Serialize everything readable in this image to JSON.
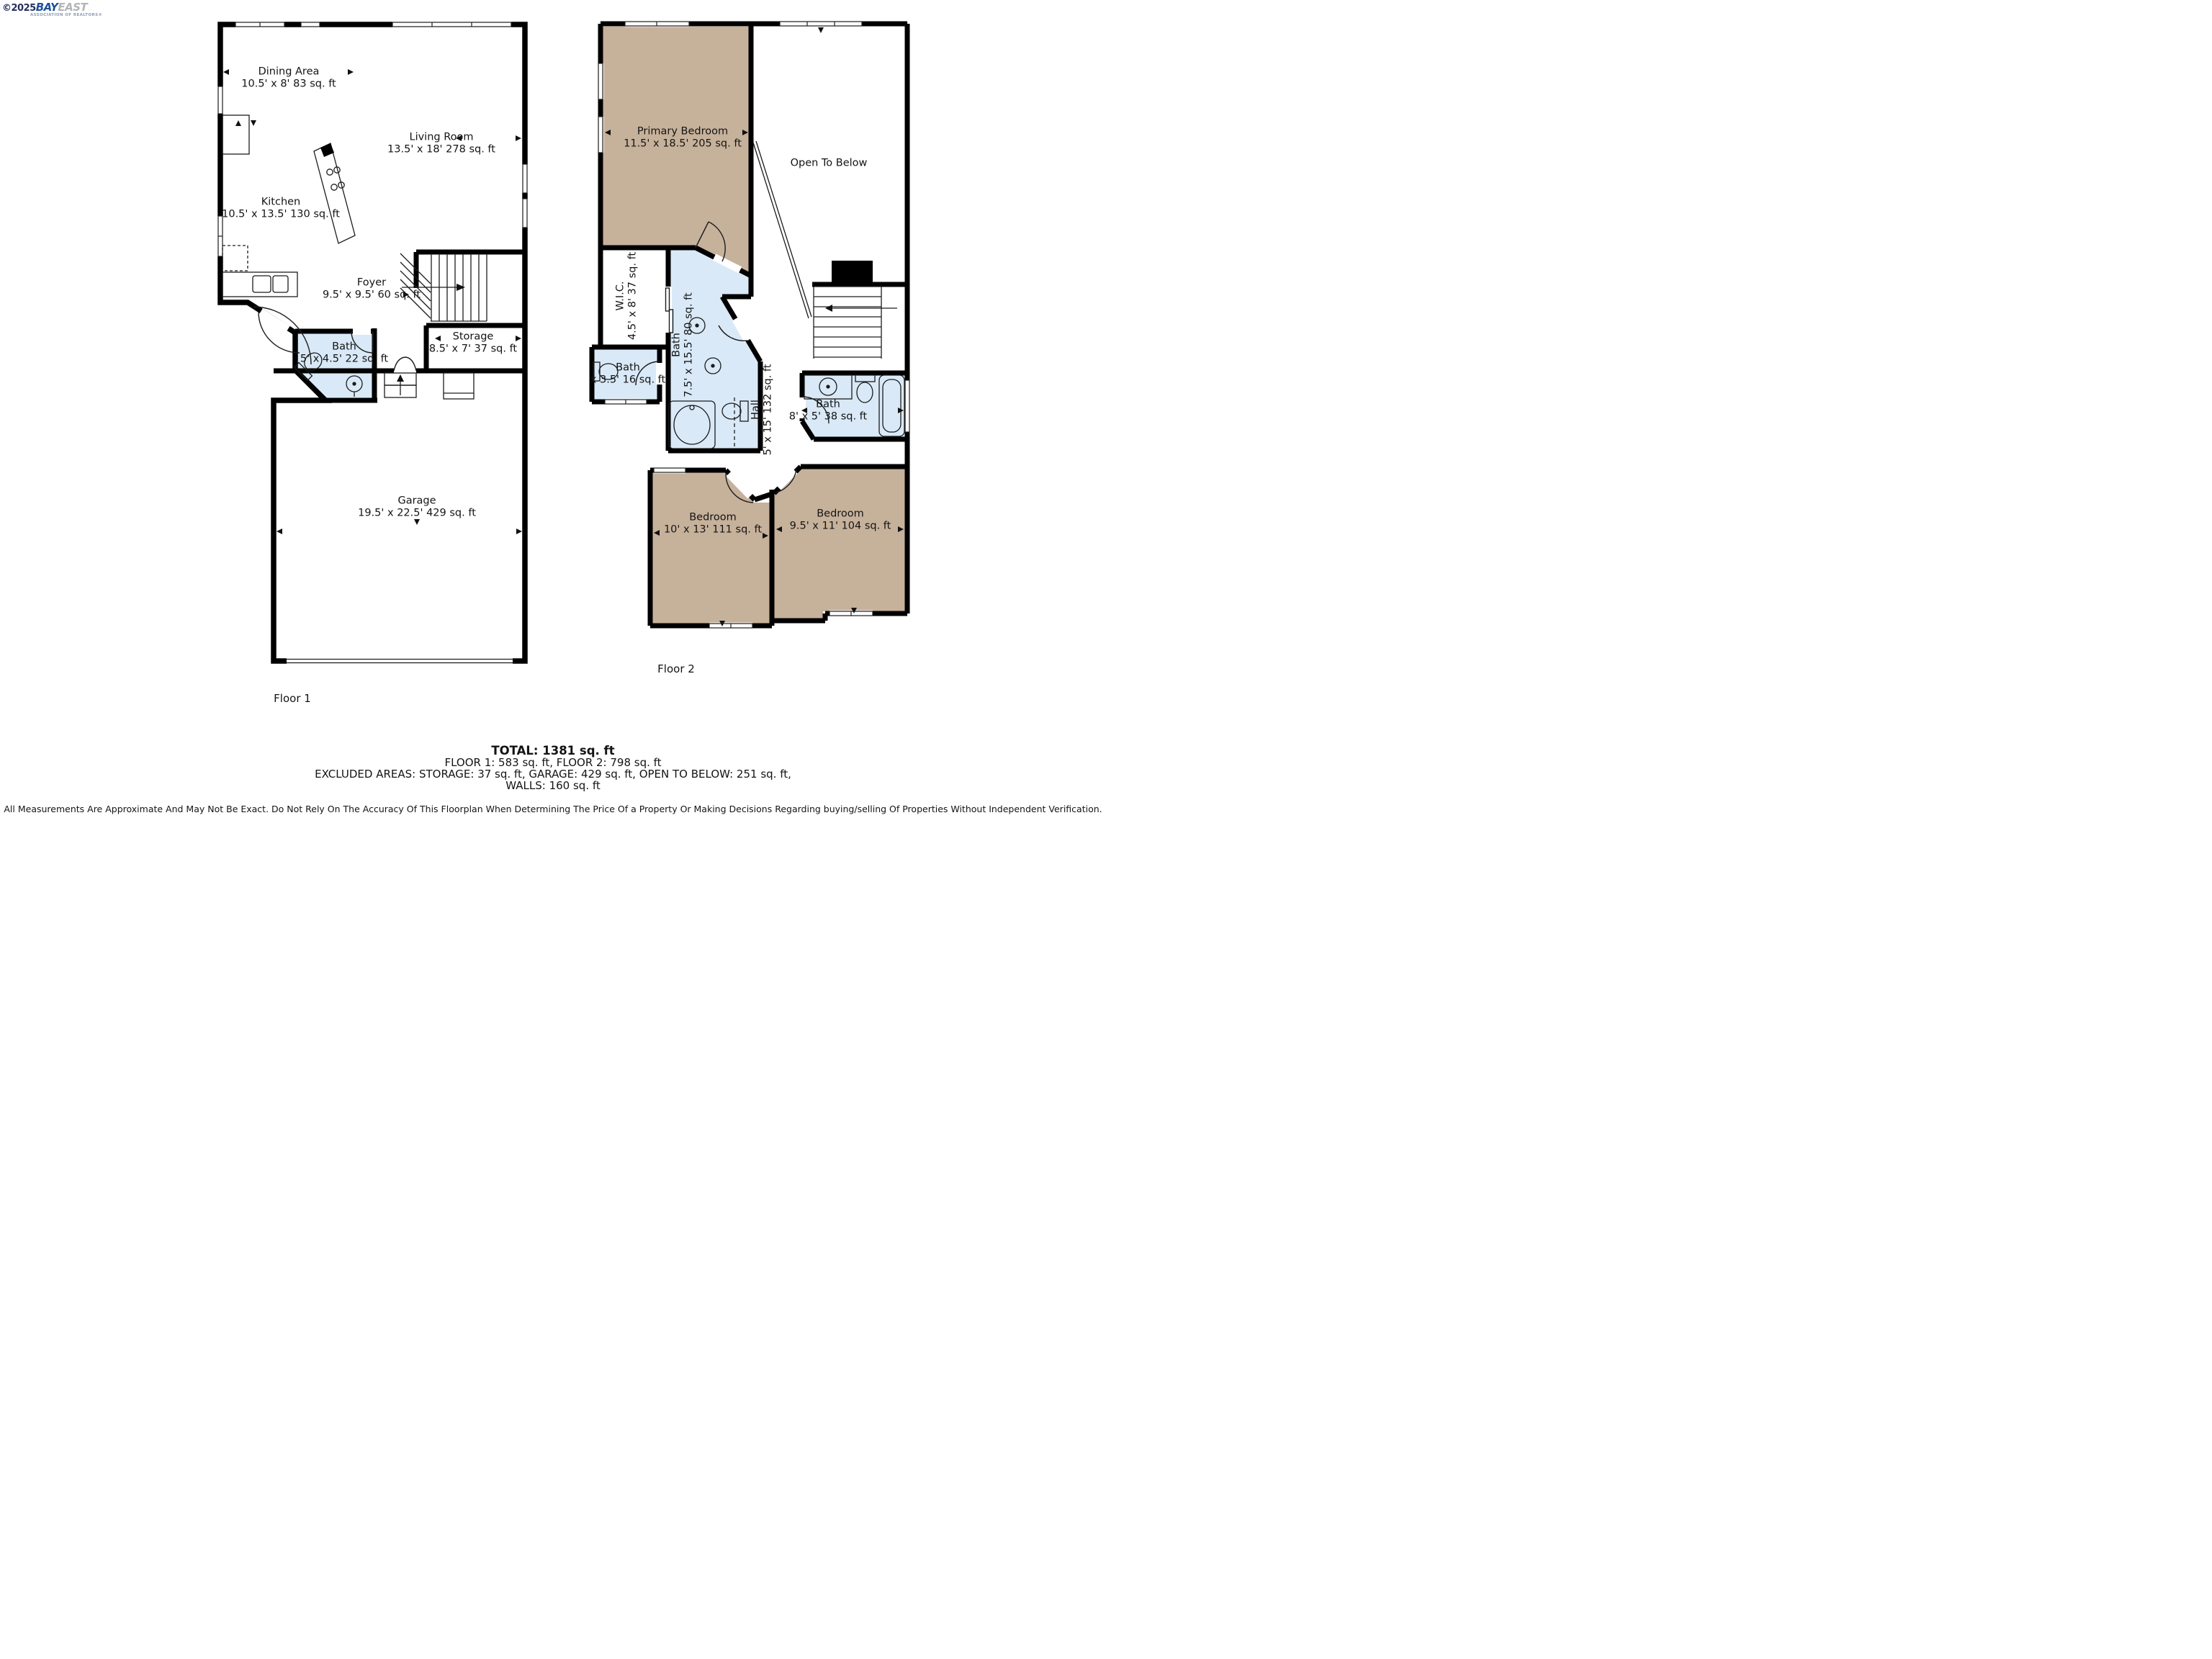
{
  "logo": {
    "copyright": "©2025",
    "brand_primary": "BAY",
    "brand_secondary": "EAST",
    "tagline": "ASSOCIATION OF REALTORS®"
  },
  "floor1": {
    "caption": "Floor 1",
    "rooms": {
      "dining": {
        "name": "Dining Area",
        "dims": "10.5' x 8' 83 sq. ft"
      },
      "living": {
        "name": "Living Room",
        "dims": "13.5' x 18' 278 sq. ft"
      },
      "kitchen": {
        "name": "Kitchen",
        "dims": "10.5' x 13.5' 130 sq. ft"
      },
      "foyer": {
        "name": "Foyer",
        "dims": "9.5' x 9.5' 60 sq. ft"
      },
      "bath": {
        "name": "Bath",
        "dims": "5' x 4.5' 22 sq. ft"
      },
      "storage": {
        "name": "Storage",
        "dims": "8.5' x 7' 37 sq. ft"
      },
      "garage": {
        "name": "Garage",
        "dims": "19.5' x 22.5' 429 sq. ft"
      }
    }
  },
  "floor2": {
    "caption": "Floor 2",
    "rooms": {
      "primary_bedroom": {
        "name": "Primary Bedroom",
        "dims": "11.5' x 18.5' 205 sq. ft"
      },
      "open_to_below": {
        "name": "Open To Below"
      },
      "wic": {
        "name": "W.I.C.",
        "dims": "4.5' x 8' 37 sq. ft"
      },
      "bath_main": {
        "name": "Bath",
        "dims": "7.5' x 15.5' 80 sq. ft"
      },
      "bath_small": {
        "name": "Bath",
        "dims": "x 3.5' 16 sq. ft"
      },
      "hall": {
        "name": "Hall",
        "dims": "5' x 15' 132 sq. ft"
      },
      "bath_right": {
        "name": "Bath",
        "dims": "8' x 5' 38 sq. ft"
      },
      "bedroom_left": {
        "name": "Bedroom",
        "dims": "10' x 13' 111 sq. ft"
      },
      "bedroom_right": {
        "name": "Bedroom",
        "dims": "9.5' x 11' 104 sq. ft"
      }
    }
  },
  "summary": {
    "total": "TOTAL: 1381 sq. ft",
    "floors": "FLOOR 1: 583 sq. ft, FLOOR 2: 798 sq. ft",
    "excluded": "EXCLUDED AREAS: STORAGE: 37 sq. ft, GARAGE: 429 sq. ft, OPEN TO BELOW: 251 sq. ft,",
    "walls": "WALLS: 160 sq. ft",
    "disclaimer": "All Measurements Are Approximate And May Not Be Exact. Do Not Rely On The Accuracy Of This Floorplan When Determining The Price Of a Property Or Making Decisions Regarding buying/selling Of Properties Without Independent Verification."
  },
  "colors": {
    "bedroom_fill": "#c6b19b",
    "bath_fill": "#d9e9f7",
    "wall": "#000000",
    "logo_blue": "#1d4f9c",
    "logo_gray": "#b4b4b6"
  }
}
